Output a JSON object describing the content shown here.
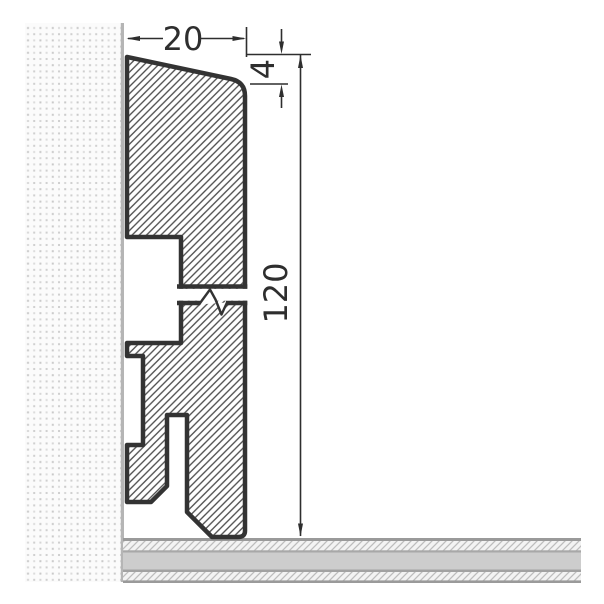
{
  "drawing": {
    "labels": {
      "top_width": "20",
      "bevel_height": "4",
      "total_height": "120"
    }
  },
  "colors": {
    "outline": "#333333",
    "dimension": "#2e2e2e",
    "hatch": "#4f4f4f",
    "wall_edge": "#b5b5b5",
    "floor_band": "#cdcdcd",
    "floor_line": "#9a9a9a"
  }
}
